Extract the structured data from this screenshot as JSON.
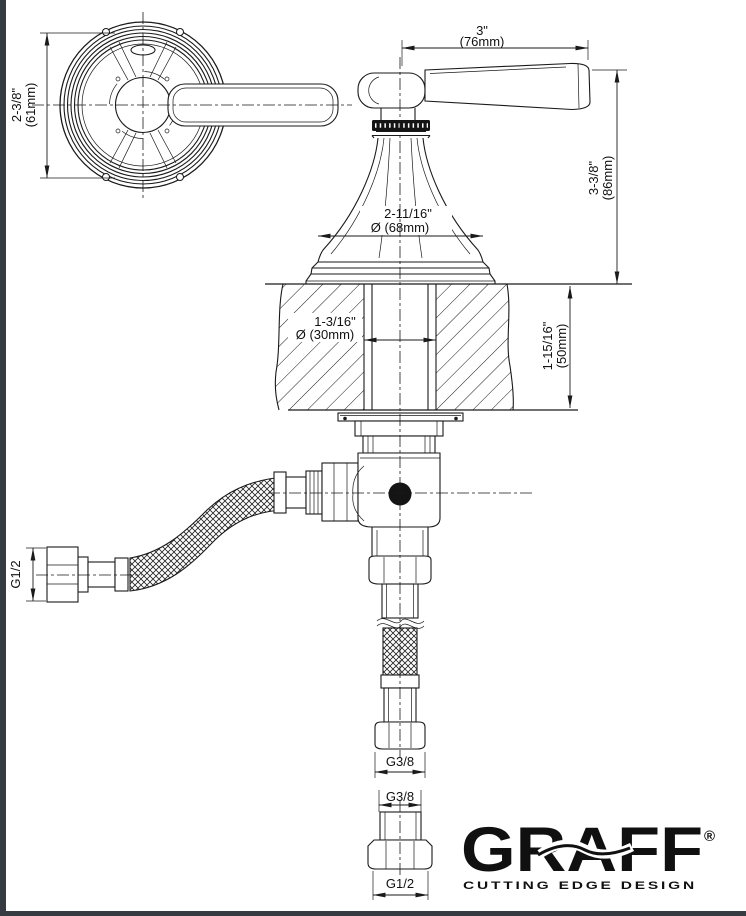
{
  "drawing": {
    "dimensions": {
      "handle_diameter": {
        "line1": "2-3/8\"",
        "line2": "(61mm)"
      },
      "handle_length": {
        "line1": "3\"",
        "line2": "(76mm)"
      },
      "handle_height": {
        "line1": "3-3/8\"",
        "line2": "(86mm)"
      },
      "escutcheon_diameter": {
        "line1": "2-11/16\"",
        "line2": "Ø (68mm)"
      },
      "hole_diameter": {
        "line1": "1-3/16\"",
        "line2": "Ø (30mm)"
      },
      "deck_thickness": {
        "line1": "1-15/16\"",
        "line2": "(50mm)"
      },
      "inlet_thread": "G1/2",
      "outlet_thread": "G3/8",
      "adapter_top_thread": "G3/8",
      "adapter_bottom_thread": "G1/2"
    },
    "logo": {
      "brand": "GRAFF",
      "registered": "®",
      "tagline": "CUTTING EDGE DESIGN"
    },
    "colors": {
      "line": "#1a1a1a",
      "logo": "#101010",
      "frame": "#363b42"
    }
  }
}
